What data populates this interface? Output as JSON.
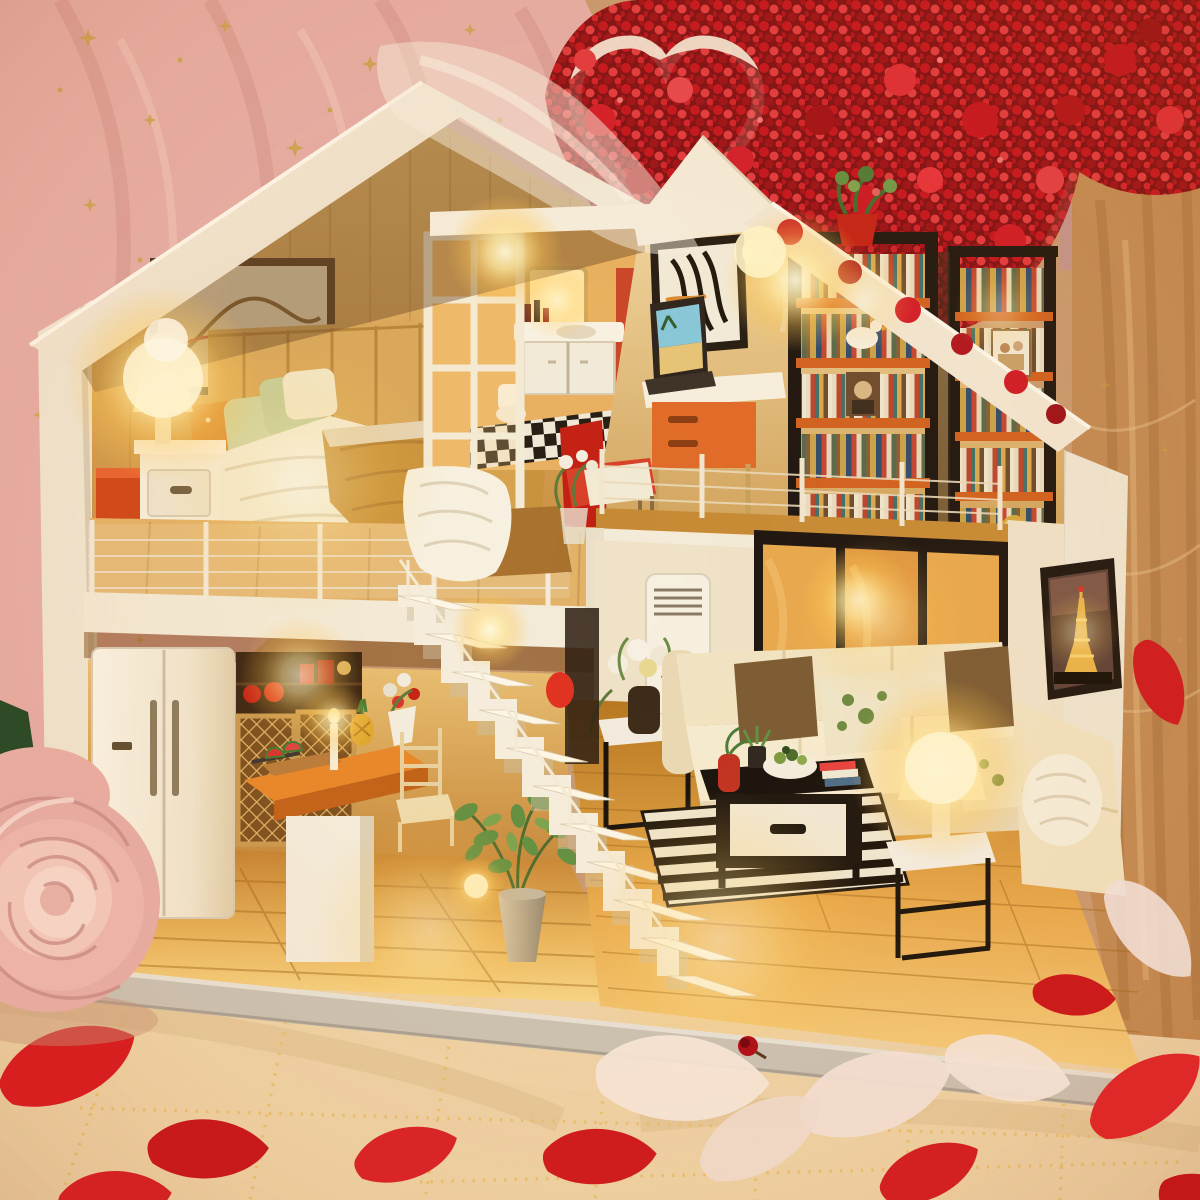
{
  "scene": {
    "title": "Miniature DIY dollhouse loft glowing warmly among red flowers, pink star curtains and scattered rose petals",
    "type": "photograph",
    "lighting": "warm amber LED glow from miniature lamps"
  },
  "palette": {
    "curtain_pink": "#e5aeaa",
    "curtain_pink_deep": "#d1918d",
    "gold": "#c9a24a",
    "flower_red": "#c4121f",
    "flower_red_dark": "#8c0d15",
    "flower_red_bright": "#e8434d",
    "heart_white": "#f2e7d8",
    "mauve_wall": "#c2948e",
    "curtain_tan": "#c08a56",
    "roof_white": "#f5eddd",
    "wall_white": "#efe7d6",
    "wood_wall": "#d8a55c",
    "shelf_orange": "#d06020",
    "accent_red": "#c42014",
    "sofa_cream": "#f1e4c4",
    "frame_black": "#1c1410",
    "base_gray": "#c9c3b9",
    "cloth_cream": "#eed5ac",
    "petal_red": "#d81f1f",
    "petal_pink": "#f4e2d4",
    "rose_pink": "#e7aa9e",
    "pure_white": "#fdfbf3",
    "glow_amber": "#ffd978"
  },
  "labels": {
    "photo": "Miniature dollhouse diorama photograph",
    "background_left": "Pink tulle curtain with gold stars and moons",
    "background_flowers": "Red dried flower bouquet",
    "heart": "White wicker heart decoration",
    "background_right": "Amber curtain backdrop",
    "house": "Two-storey miniature loft dollhouse",
    "bedroom": "Loft bedroom with glowing bedside lamp and double bed",
    "bathroom": "Washroom with lit mirror, vanity and checkered floor",
    "study": "Reading corner with desk, laptop, red chair and two bookcases",
    "kitchen": "Kitchen with fridge, lattice cabinets and island counter",
    "living_room": "Living room with cream corner sofa, lamps and Eiffel Tower print",
    "stairs": "White open-riser staircase",
    "base": "Silver display base platform",
    "foreground": "Champagne sequin tablecloth with scattered rose petals",
    "rose": "Large pink rose"
  }
}
